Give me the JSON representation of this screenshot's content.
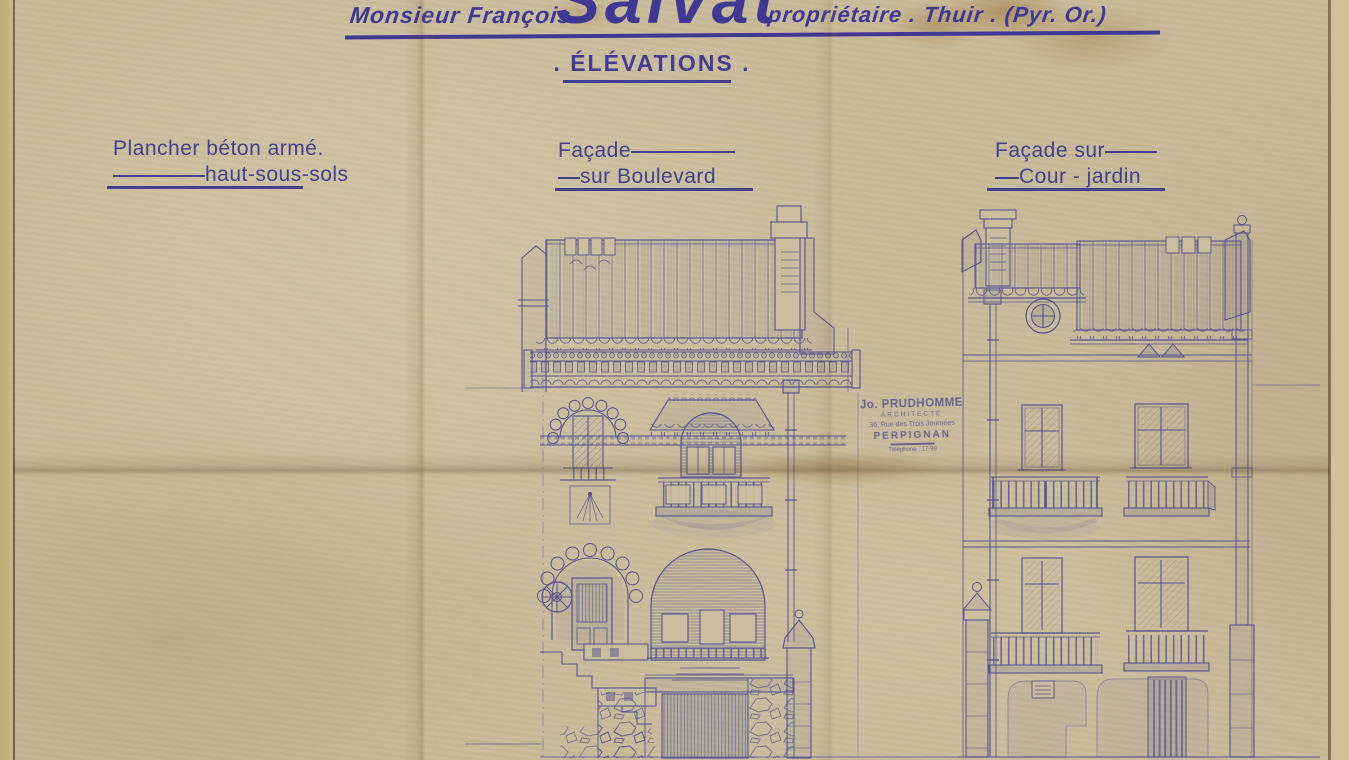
{
  "sheet": {
    "title": {
      "prefix": "Monsieur François",
      "name": "Salvat",
      "suffix": "propriétaire . Thuir . (Pyr. Or.)"
    },
    "heading": ". ÉLÉVATIONS .",
    "labels": {
      "floor_line1": "Plancher béton armé.",
      "floor_line2": "haut-sous-sols",
      "boulevard_line1": "Façade",
      "boulevard_line2": "sur Boulevard",
      "garden_line1": "Façade sur",
      "garden_line2": "Cour - jardin"
    },
    "stamp": {
      "name": "Jo. PRUDHOMME",
      "role": "ARCHITECTE",
      "address": "36, Rue des Trois Journées",
      "city": "PERPIGNAN",
      "phone": "Téléphone : 17-98"
    },
    "colors": {
      "ink": "#4a4290",
      "paper": "#c8bb9a",
      "stamp_ink": "#5a4f8e"
    }
  }
}
